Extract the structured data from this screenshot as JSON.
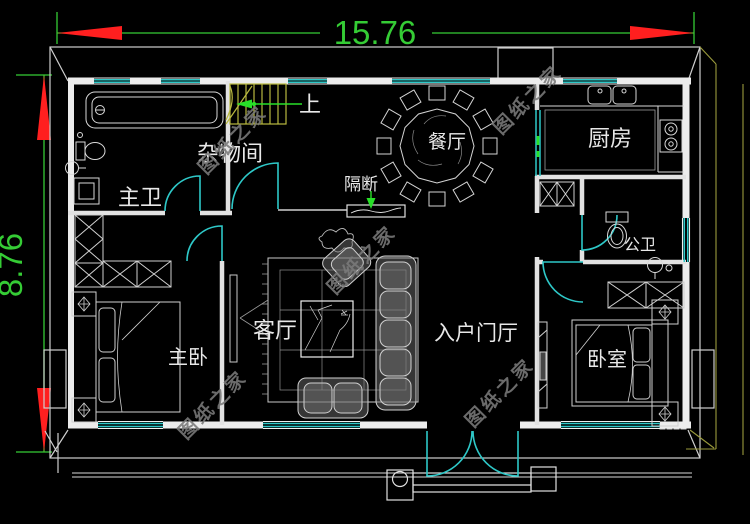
{
  "dimensions": {
    "width_label": "15.76",
    "height_label": "8.76"
  },
  "labels": {
    "master_bath": "主卫",
    "storage_room": "杂物间",
    "stairs_up": "上",
    "dining_room": "餐厅",
    "kitchen": "厨房",
    "partition": "隔断",
    "public_bath": "公卫",
    "living_room": "客厅",
    "master_bedroom": "主卧",
    "entry_hall": "入户门厅",
    "bedroom": "卧室"
  },
  "watermark": {
    "text": "图纸之家"
  },
  "colors": {
    "background": "#000000",
    "wall": "#ececec",
    "window_door": "#2ec8c8",
    "dimension": "#35cc35",
    "dimension_arrow": "#ff1f1f",
    "stairs": "#b9b93f",
    "eave_accent": "#9a9a3c",
    "watermark": "#7a7a7a"
  }
}
